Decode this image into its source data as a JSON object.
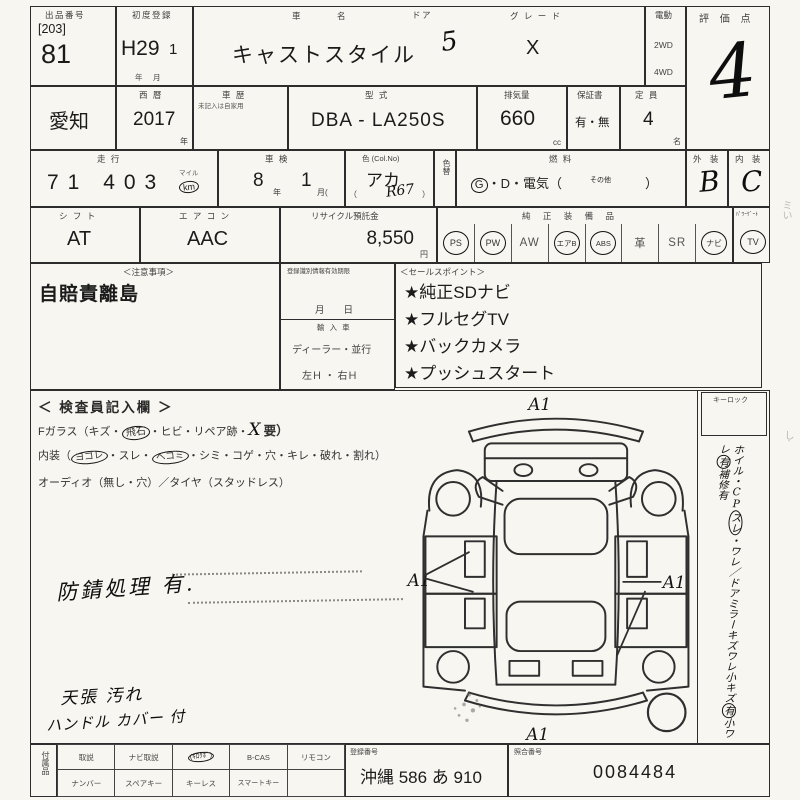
{
  "colors": {
    "paper": "#f7f6f1",
    "ink": "#1c1c1c",
    "pen": "#101010"
  },
  "header": {
    "auction_no_label": "出品番号",
    "auction_no_bracket": "[203]",
    "auction_no": "81",
    "first_reg_label": "初度登録",
    "first_reg": "H29",
    "first_reg_month": "1",
    "first_reg_units": "年　月",
    "car_name_label": "車　名",
    "car_name": "キャストスタイル",
    "door_label": "ドア",
    "door": "5",
    "grade_label": "グ レ ー ド",
    "grade": "X",
    "drive_label": "電動",
    "drive_2wd": "2WD",
    "drive_4wd": "4WD",
    "score_label": "評 価 点",
    "score": "4"
  },
  "row2": {
    "prefecture": "愛知",
    "year_label": "西 暦",
    "year": "2017",
    "year_unit": "年",
    "history_label": "車 歴",
    "history_note": "未記入は自家用",
    "model_label": "型 式",
    "model": "DBA - LA250S",
    "disp_label": "排気量",
    "disp": "660",
    "disp_unit": "cc",
    "warranty_label": "保証書",
    "warranty": "有・無",
    "capacity_label": "定 員",
    "capacity": "4",
    "capacity_unit": "名"
  },
  "row3": {
    "mileage_label": "走 行",
    "mileage": "71 403",
    "mileage_unit_top": "マイル",
    "mileage_unit": "km",
    "inspection_label": "車 検",
    "inspection_year": "8",
    "inspection_year_unit": "年",
    "inspection_month": "1",
    "inspection_month_unit": "月(",
    "color_label": "色 (Col.No)",
    "color": "アカ",
    "color_code": "R67",
    "paren_open": "（",
    "paren_close": "）",
    "color_change_label": "色替",
    "fuel_label": "燃 料",
    "fuel_g": "G",
    "fuel_rest": "・D・電気（",
    "fuel_other": "その他",
    "fuel_close": "）",
    "exterior_label": "外 装",
    "exterior": "B",
    "interior_label": "内 装",
    "interior": "C"
  },
  "row4": {
    "shift_label": "シ フ ト",
    "shift": "AT",
    "aircon_label": "エ ア コ ン",
    "aircon": "AAC",
    "recycle_label": "リサイクル預託金",
    "recycle": "8,550",
    "recycle_unit": "円",
    "equip_label": "純 正 装 備 品",
    "equip": [
      {
        "text": "PS",
        "circled": true
      },
      {
        "text": "PW",
        "circled": true
      },
      {
        "text": "AW",
        "circled": false
      },
      {
        "text": "エアB",
        "circled": true
      },
      {
        "text": "ABS",
        "circled": true
      },
      {
        "text": "革",
        "circled": false
      },
      {
        "text": "SR",
        "circled": false
      },
      {
        "text": "ナビ",
        "circled": true
      }
    ],
    "tv_label": "ﾊﾟﾜｰｹﾞｰﾄ",
    "tv": "TV",
    "tv_circled": true
  },
  "row5": {
    "notes_label": "＜注意事項＞",
    "notes": "自賠責離島",
    "regid_label": "登録識別情報有効期限",
    "regid_date": "月　　日",
    "import_label": "輸 入 車",
    "import_type": "ディーラー・並行",
    "handle": "左Ｈ ・ 右Ｈ",
    "sales_label": "＜セールスポイント＞",
    "sales_points": [
      "★純正SDナビ",
      "★フルセグTV",
      "★バックカメラ",
      "★プッシュスタート"
    ]
  },
  "inspector": {
    "title": "＜ 検査員記入欄 ＞",
    "glass_prefix": "Fガラス（キズ・",
    "glass_circled": "飛石",
    "glass_mid": "・ヒビ・リペア跡・",
    "glass_x": "X",
    "glass_suffix": "要）",
    "int_prefix": "内装（",
    "int_c1": "ヨゴレ",
    "int_m1": "・スレ・",
    "int_c2": "ヘコミ",
    "int_suffix": "・シミ・コゲ・穴・キレ・破れ・割れ）",
    "audio_line": "オーディオ（無し・穴）／タイヤ（スタッドレス）",
    "note_rust": "防錆処理 有.",
    "note_roof": "天張 汚れ",
    "note_handle": "ハンドル カバー 付"
  },
  "diagram": {
    "mark_front": "A1",
    "mark_left": "A1",
    "mark_right": "A1",
    "mark_rear": "A1"
  },
  "sidebar": {
    "keylock_label": "キーロック",
    "s1": "ホイル・CP",
    "s2": "スレ",
    "s3": "・ワレ／ドアミラーキズワレ",
    "s4": "小キズ",
    "s5": "有",
    "s6": "小ワレ",
    "s7": "有",
    "s8": "補修有"
  },
  "bottom": {
    "acc_label": "付属品",
    "r1c1": "取説",
    "r1c2": "ナビ取説",
    "r1c3": "(ｷﾛｸﾎﾞ)",
    "r1c4": "B-CAS",
    "r1c5": "リモコン",
    "r2c1": "ナンバー",
    "r2c2": "スペアキー",
    "r2c3": "キーレス",
    "r2c4": "スマートキー",
    "r2c5": "",
    "regno_label": "登録番号",
    "regno": "沖縄 586 あ 910",
    "refno_label": "照合番号",
    "refno": "0084484"
  }
}
